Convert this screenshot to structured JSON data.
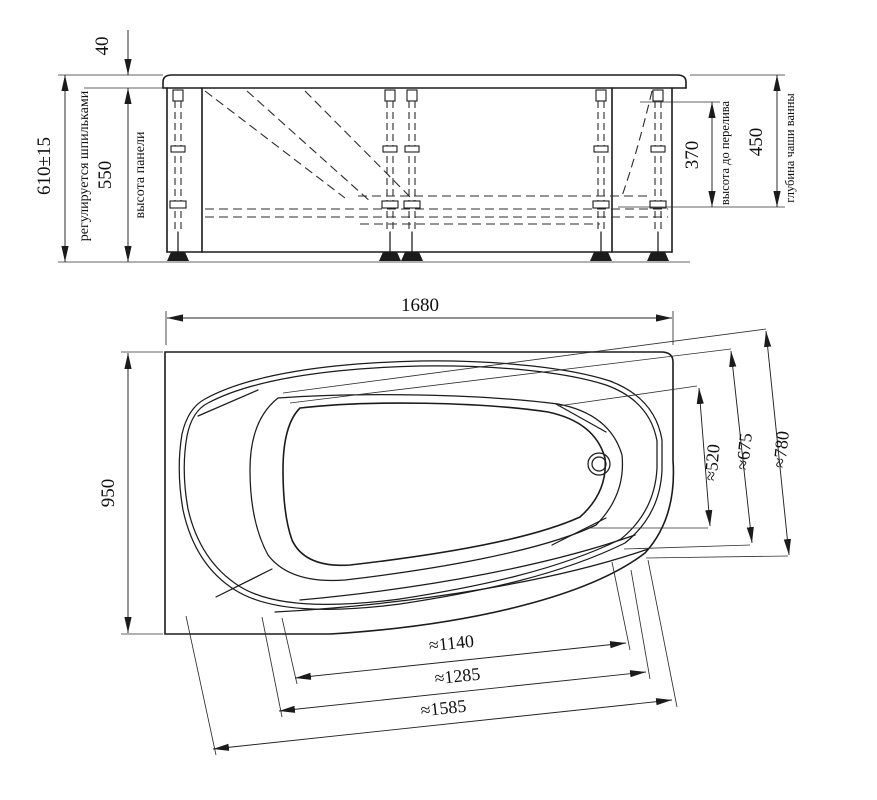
{
  "side_view": {
    "dim_rim_height": "40",
    "dim_total_height": "610±15",
    "note_total_height": "регулируется шпильками",
    "dim_panel_height": "550",
    "label_panel_height": "высота панели",
    "dim_overflow_height": "370",
    "label_overflow_height": "высота до перелива",
    "dim_bowl_depth": "450",
    "label_bowl_depth": "глубина чаши ванны"
  },
  "plan_view": {
    "dim_length": "1680",
    "dim_width": "950",
    "dim_right_inner": "≈520",
    "dim_right_middle": "≈675",
    "dim_right_outer": "≈780",
    "dim_bottom_inner": "≈1140",
    "dim_bottom_middle": "≈1285",
    "dim_bottom_outer": "≈1585"
  }
}
